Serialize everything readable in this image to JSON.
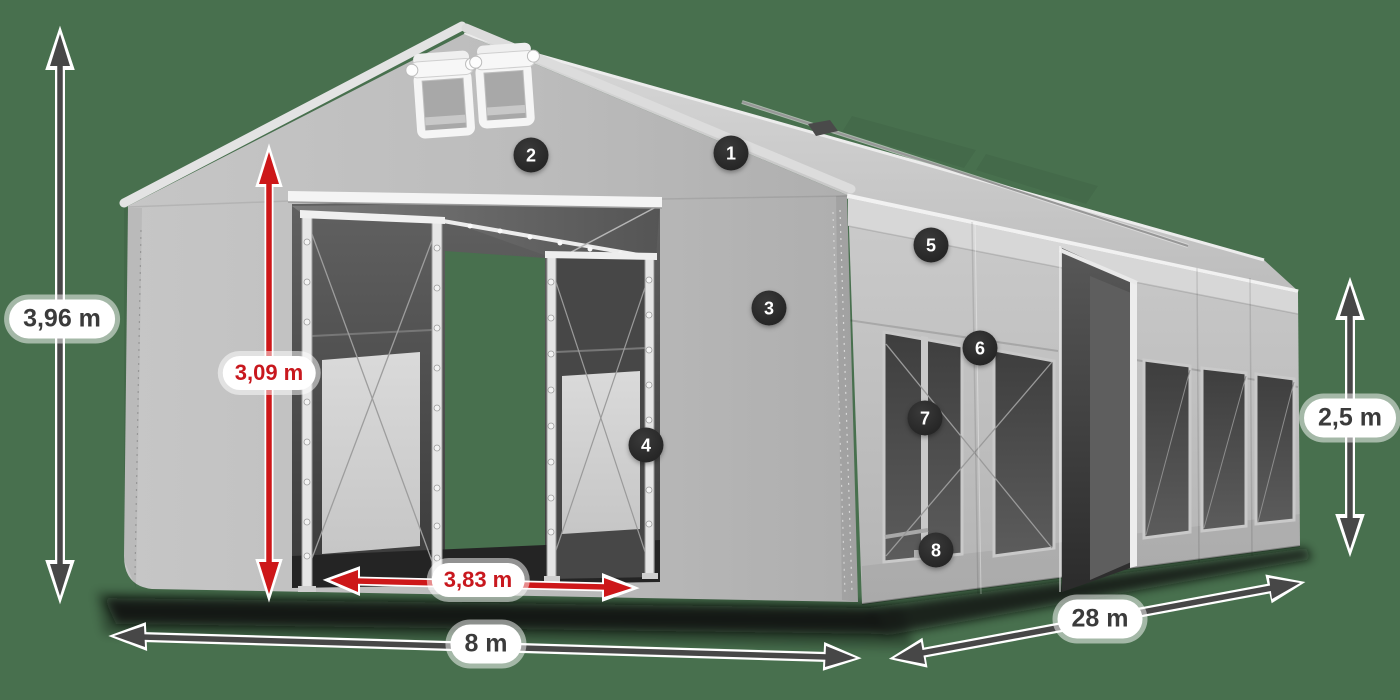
{
  "colors": {
    "background": "#48704e",
    "fabric": "#bfbfbf",
    "fabric_light": "#d9d9d9",
    "fabric_dark": "#a8a8a8",
    "interior": "#434343",
    "window": "#4a4a4a",
    "frame_white": "#f2f2f2",
    "arrow_gray": "#474747",
    "arrow_red": "#cd1719",
    "label_bg": "#ffffff",
    "label_text": "#3b3b3b",
    "label_text_red": "#c8181e",
    "callout_bg": "#262626",
    "callout_text": "#ffffff"
  },
  "dimensions": {
    "total_height": {
      "label": "3,96 m"
    },
    "door_height": {
      "label": "3,09 m"
    },
    "door_width": {
      "label": "3,83 m"
    },
    "front_width": {
      "label": "8 m"
    },
    "length": {
      "label": "28 m"
    },
    "side_height": {
      "label": "2,5 m"
    }
  },
  "callouts": [
    {
      "number": "1"
    },
    {
      "number": "2"
    },
    {
      "number": "3"
    },
    {
      "number": "4"
    },
    {
      "number": "5"
    },
    {
      "number": "6"
    },
    {
      "number": "7"
    },
    {
      "number": "8"
    }
  ]
}
